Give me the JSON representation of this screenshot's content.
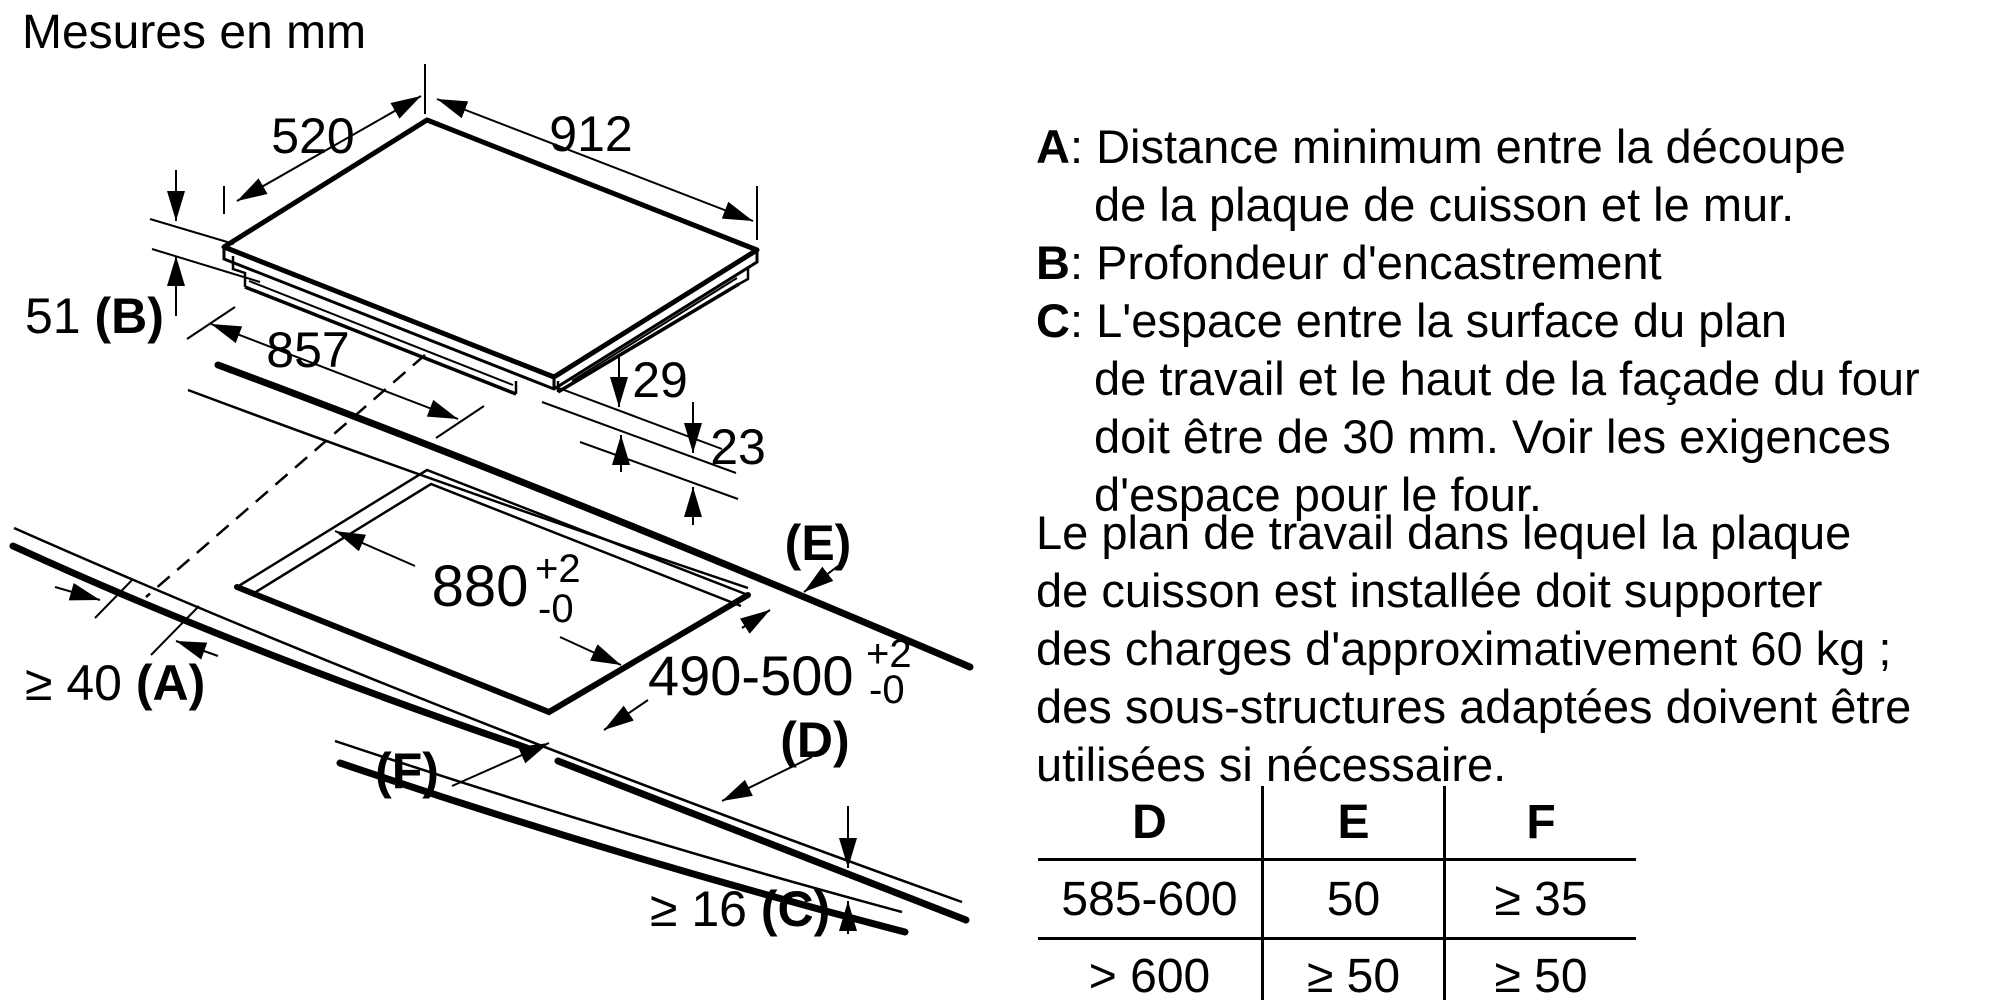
{
  "title": "Mesures en mm",
  "diagram": {
    "dims": {
      "width_top": "520",
      "length_top": "912",
      "box_length": "857",
      "depth_value": "51 ",
      "depth_ref": "(B)",
      "h29": "29",
      "h23": "23",
      "cutout_length": "880",
      "cutout_length_tol_plus": "+2",
      "cutout_length_tol_minus": "-0",
      "cutout_width": "490-500",
      "cutout_width_tol_plus": "+2",
      "cutout_width_tol_minus": "-0",
      "wall_value": "≥ 40 ",
      "wall_ref": "(A)",
      "thickness_value": "≥ 16 ",
      "thickness_ref": "(C)",
      "ref_e": "(E)",
      "ref_d": "(D)",
      "ref_f": "(F)"
    }
  },
  "legend": {
    "a_letter": "A",
    "a_sep": ": ",
    "a_line1": "Distance minimum entre la découpe",
    "a_line2": "de la plaque de cuisson et le mur.",
    "b_letter": "B",
    "b_sep": ": ",
    "b_line1": "Profondeur d'encastrement",
    "c_letter": "C",
    "c_sep": ": ",
    "c_line1": "L'espace entre la surface du plan",
    "c_line2": "de travail et le haut de la façade du four",
    "c_line3": "doit être de 30 mm. Voir les exigences",
    "c_line4": "d'espace pour le four."
  },
  "paragraph": {
    "line1": "Le plan de travail dans lequel la plaque",
    "line2": "de cuisson est installée doit supporter",
    "line3": "des charges d'approximativement 60 kg ;",
    "line4": "des sous-structures adaptées doivent être",
    "line5": "utilisées si nécessaire."
  },
  "table": {
    "headers": [
      "D",
      "E",
      "F"
    ],
    "rows": [
      [
        "585-600",
        "50",
        "≥ 35"
      ],
      [
        "> 600",
        "≥ 50",
        "≥ 50"
      ]
    ]
  }
}
